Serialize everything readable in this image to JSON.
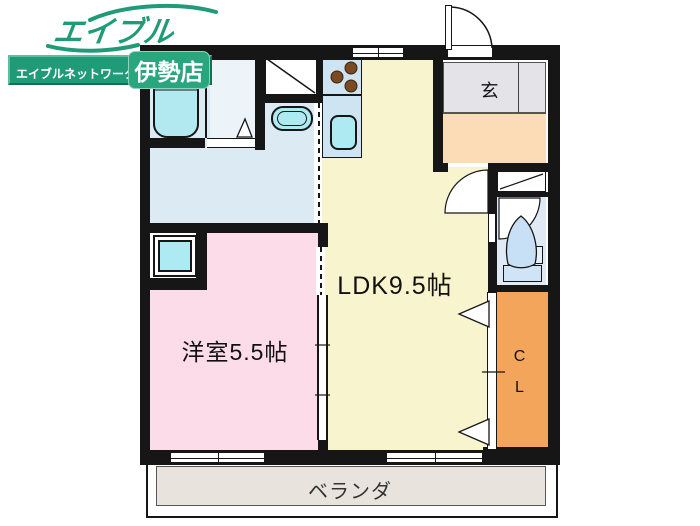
{
  "branding": {
    "logo": "エイブル",
    "network": "エイブルネットワーク",
    "store": "伊勢店",
    "brand_green": "#1f9c77"
  },
  "plan": {
    "ldk_label": "LDK9.5帖",
    "bedroom_label": "洋室5.5帖",
    "entrance_label": "玄",
    "closet_c": "C",
    "closet_l": "L",
    "balcony_label": "ベランダ"
  },
  "colors": {
    "wall": "#161616",
    "ldk_yellow": "#f8f4cd",
    "bedroom_pink": "#fbdce8",
    "closet_orange": "#f3a65b",
    "hall_peach": "#fbdcb6",
    "entry_gray": "#e4e4e8",
    "balcony_gray": "#e8e4dd",
    "wet_area_blue": "#dceaf4",
    "fixture_cyan": "#aeeaf2",
    "counter_blue": "#cfe4f2",
    "burner_brown": "#7a4a22"
  },
  "fixtures": [
    "bathtub",
    "washing-machine-space",
    "wash-basin",
    "stove-burners",
    "kitchen-sink",
    "toilet",
    "entrance-door",
    "closet-folding-doors",
    "sliding-windows"
  ]
}
